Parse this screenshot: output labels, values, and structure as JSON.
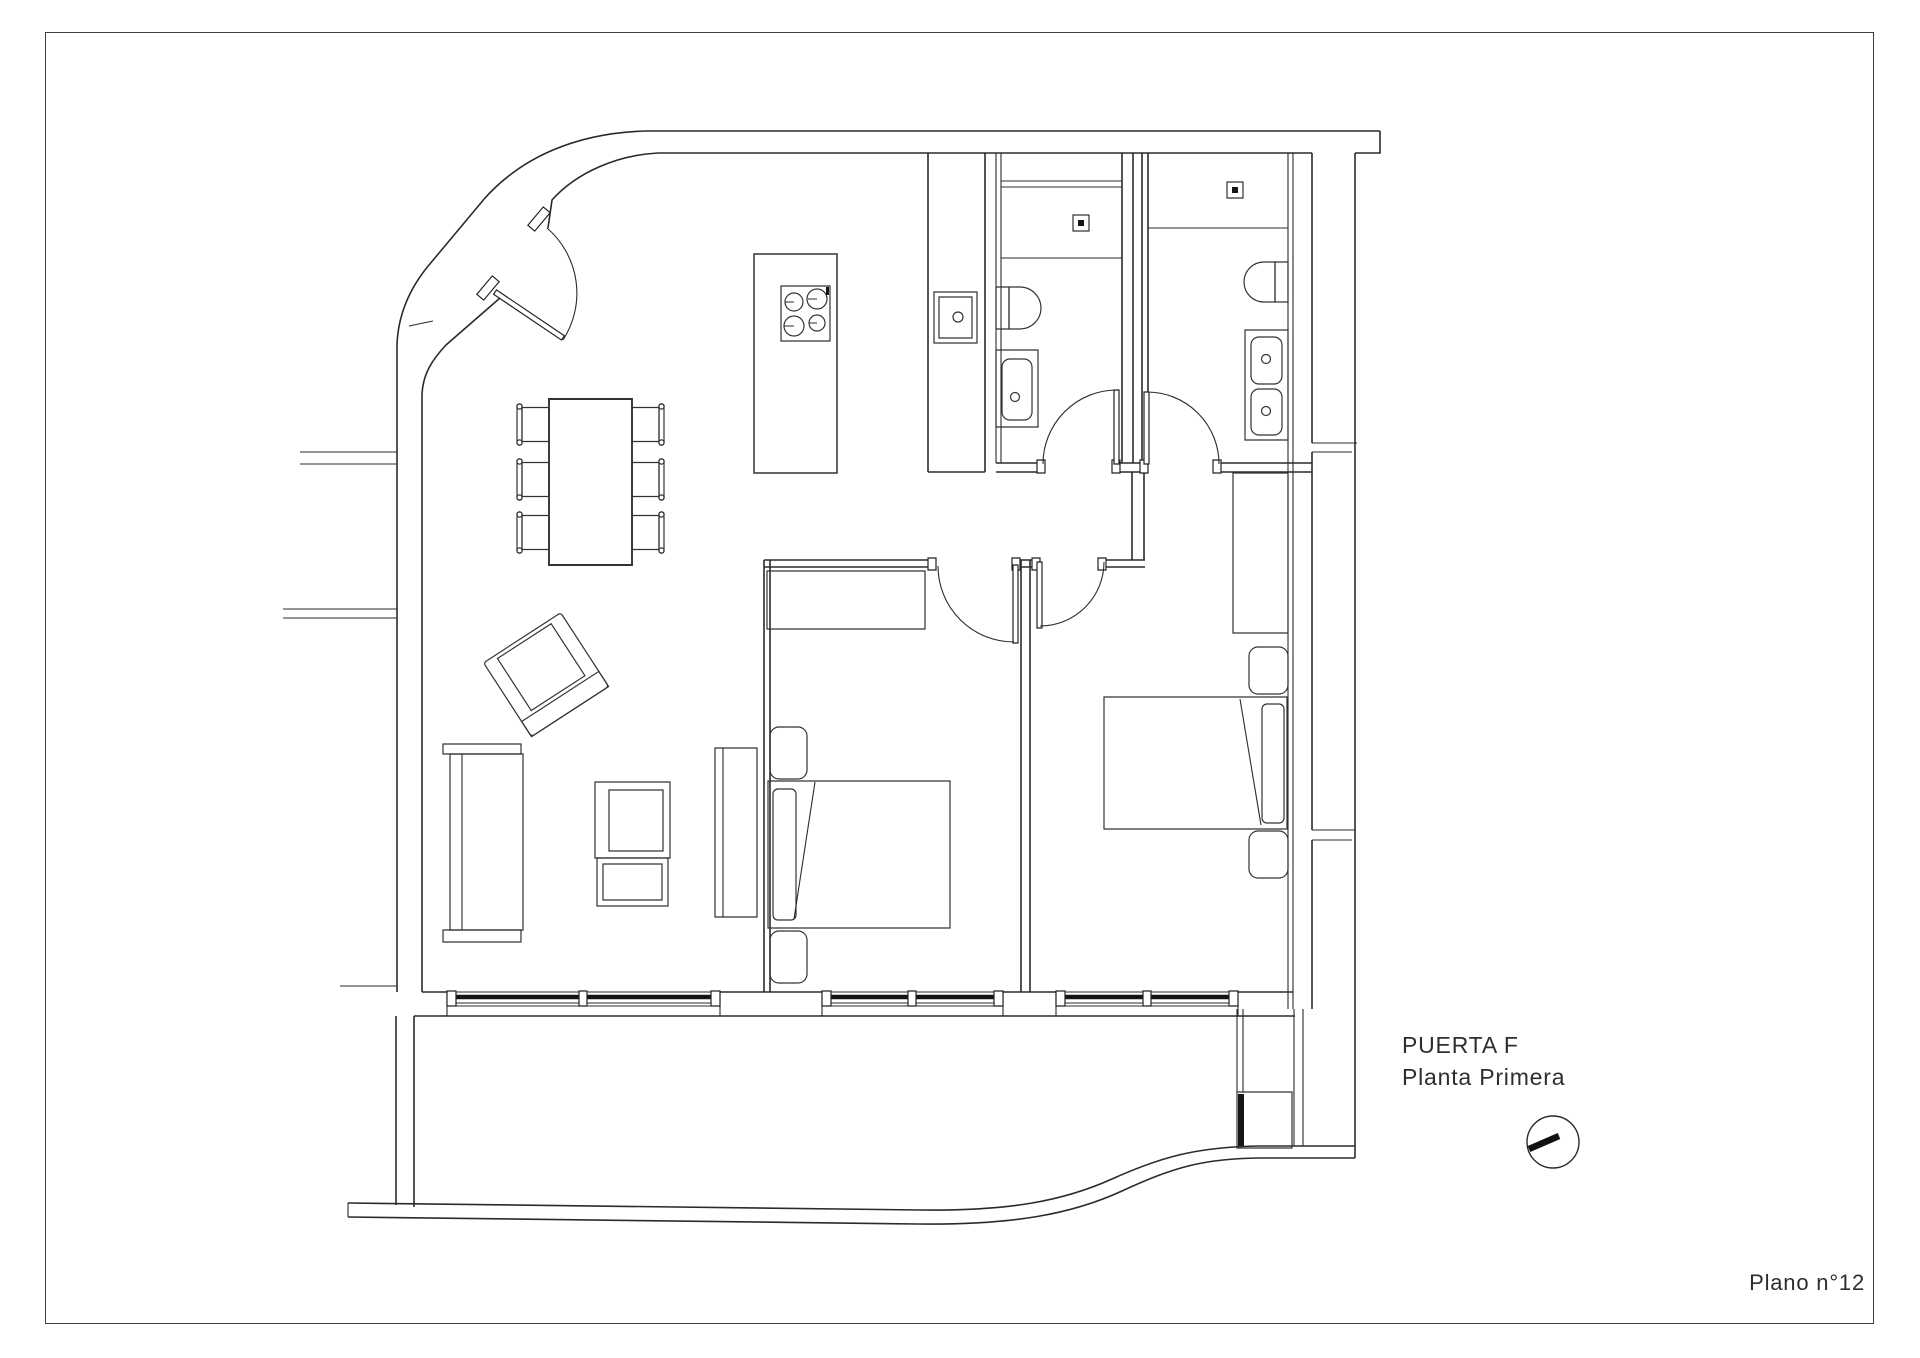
{
  "title_block": {
    "apartment": "PUERTA F",
    "floor": "Planta Primera",
    "sheet": "Plano n°12"
  },
  "colors": {
    "paper": "#ffffff",
    "line": "#2b2b2b",
    "window_band": "#141414",
    "border": "#3f3f3f"
  },
  "symbols": {
    "orientation": "clock-orientation-symbol"
  }
}
